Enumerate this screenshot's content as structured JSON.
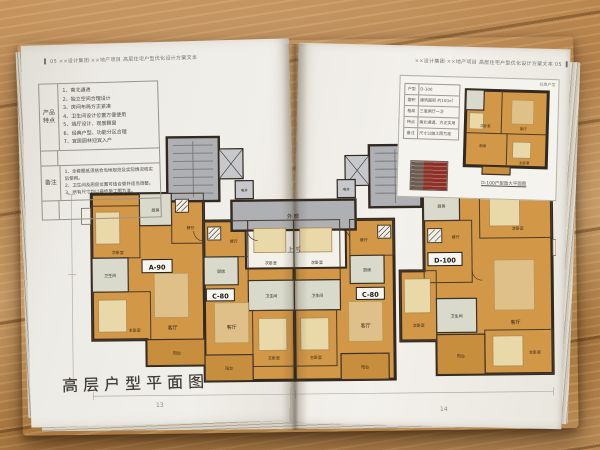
{
  "document": {
    "left_page": {
      "header": "▌ 05  ××设计集团·××地产项目 高层住宅户型优化设计方案文本",
      "page_number": "13",
      "product_table": {
        "section1_label": "产品特点",
        "features": [
          "1、南北通透",
          "2、独立空间合理设计",
          "3、房间布局方正紧凑",
          "4、卫生间设计位置方便使用",
          "5、端厅设计、观景飘窗",
          "6、经典户型、功能分区合理",
          "7、宜居园林迎宾入户"
        ],
        "section2_label": "备注",
        "notes": [
          "1、全套图纸须结合当地规范及实际情况核实后使用。",
          "2、卫生间及厨房位置可结合管井适当调整。",
          "3、所有尺寸均以最终施工图为准。"
        ]
      },
      "plan_title": "高层户型平面图"
    },
    "right_page": {
      "header": "××设计集团·××地产项目 高层住宅户型优化设计方案文本  05 ▐",
      "page_number": "14",
      "inset": {
        "corner_label": "经典户型",
        "caption": "D-100户型放大平面图",
        "table_rows": [
          {
            "label": "户型",
            "value": "D-100"
          },
          {
            "label": "面积",
            "value": "建筑面积 约100㎡"
          },
          {
            "label": "格局",
            "value": "三室两厅一卫"
          },
          {
            "label": "特点",
            "value": "南北通透、方正实用"
          },
          {
            "label": "备注",
            "value": "尺寸以施工图为准"
          }
        ]
      }
    },
    "floor_plan": {
      "units": [
        "A-90",
        "C-80",
        "C-80",
        "D-100"
      ],
      "rooms": {
        "living": "客厅",
        "dining": "餐厅",
        "kitchen": "厨房",
        "bath": "卫生间",
        "master": "主卧室",
        "second": "次卧室",
        "balcony": "阳台",
        "corridor": "外廊",
        "void_above": "上空",
        "shaft": "电井"
      }
    },
    "colors": {
      "room_fill": "#d29747",
      "balcony_fill": "#c78f3d",
      "wall": "#322920",
      "core_gray": "#aeb0b3",
      "light_room": "#d9dacb",
      "page": "#edebe5",
      "wood": "#b5854c",
      "elevation_red": "#8d3126"
    }
  }
}
